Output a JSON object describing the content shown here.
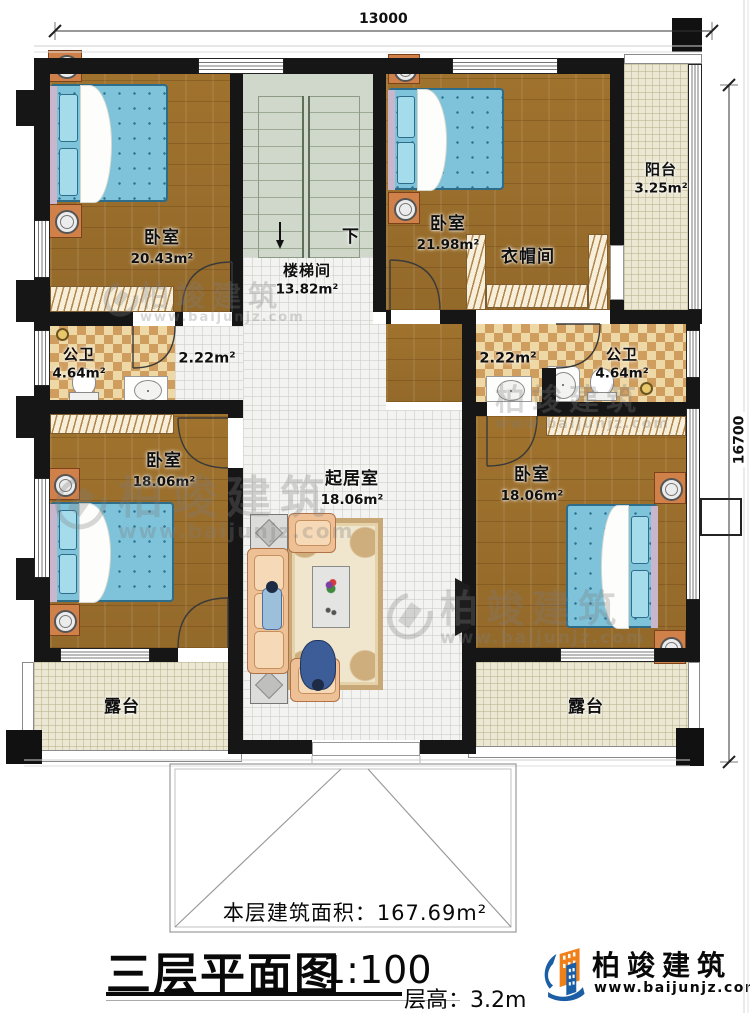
{
  "plan": {
    "dimension_top": "13000",
    "dimension_right": "16700",
    "rooms": {
      "bedroom_top_left": {
        "name": "卧室",
        "area": "20.43m²"
      },
      "stairwell": {
        "name": "楼梯间",
        "area": "13.82m²",
        "down": "下"
      },
      "bedroom_top_right": {
        "name": "卧室",
        "area": "21.98m²"
      },
      "cloakroom": {
        "name": "衣帽间"
      },
      "balcony": {
        "name": "阳台",
        "area": "3.25m²"
      },
      "bathroom_left": {
        "name": "公卫",
        "area": "4.64m²"
      },
      "hall_left": {
        "area": "2.22m²"
      },
      "hall_right": {
        "area": "2.22m²"
      },
      "bathroom_right": {
        "name": "公卫",
        "area": "4.64m²"
      },
      "bedroom_mid_left": {
        "name": "卧室",
        "area": "18.06m²"
      },
      "living_room": {
        "name": "起居室",
        "area": "18.06m²"
      },
      "bedroom_mid_right": {
        "name": "卧室",
        "area": "18.06m²"
      },
      "terrace_left": {
        "name": "露台"
      },
      "terrace_right": {
        "name": "露台"
      }
    }
  },
  "footer": {
    "floor_area": "本层建筑面积：167.69m²",
    "title": "三层平面图",
    "scale": "1:100",
    "floor_height": "层高：3.2m"
  },
  "brand": {
    "name": "柏竣建筑",
    "url": "www.baijunjz.com"
  },
  "watermark": {
    "name": "柏竣建筑",
    "url": "www.baijunjz.com"
  }
}
